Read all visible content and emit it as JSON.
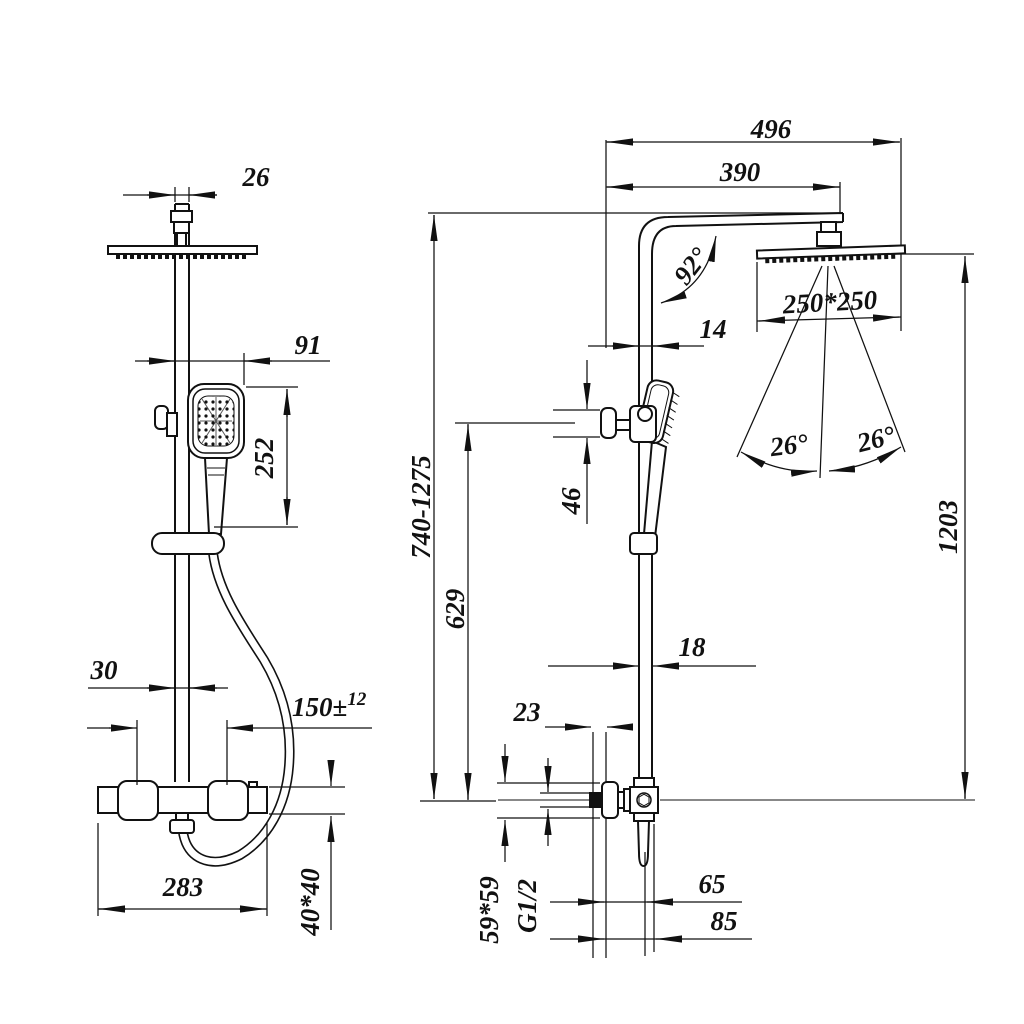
{
  "drawing": {
    "background": "#ffffff",
    "line_color": "#111111",
    "views": {
      "front": {
        "dim_head_connector_width": "26",
        "dim_handshower_offset": "91",
        "dim_handshower_length": "252",
        "dim_pipe_width": "30",
        "dim_inlet_spacing": "150±",
        "dim_inlet_spacing_tolerance": "12",
        "dim_valve_width": "283",
        "dim_column_profile": "40*40"
      },
      "side": {
        "dim_arm_reach_total": "496",
        "dim_arm_length": "390",
        "dim_arm_angle": "92°",
        "dim_head_size": "250*250",
        "dim_upper_pipe_depth": "14",
        "dim_spray_angle_left": "26°",
        "dim_spray_angle_right": "26°",
        "dim_holder_height": "46",
        "dim_column_height_range": "740-1275",
        "dim_slide_height": "629",
        "dim_overall_height": "1203",
        "dim_lower_pipe_depth": "18",
        "dim_wall_clearance": "23",
        "dim_escutcheon_size": "59*59",
        "dim_inlet_thread": "G1/2",
        "dim_spout_reach": "65",
        "dim_body_depth": "85"
      }
    }
  }
}
